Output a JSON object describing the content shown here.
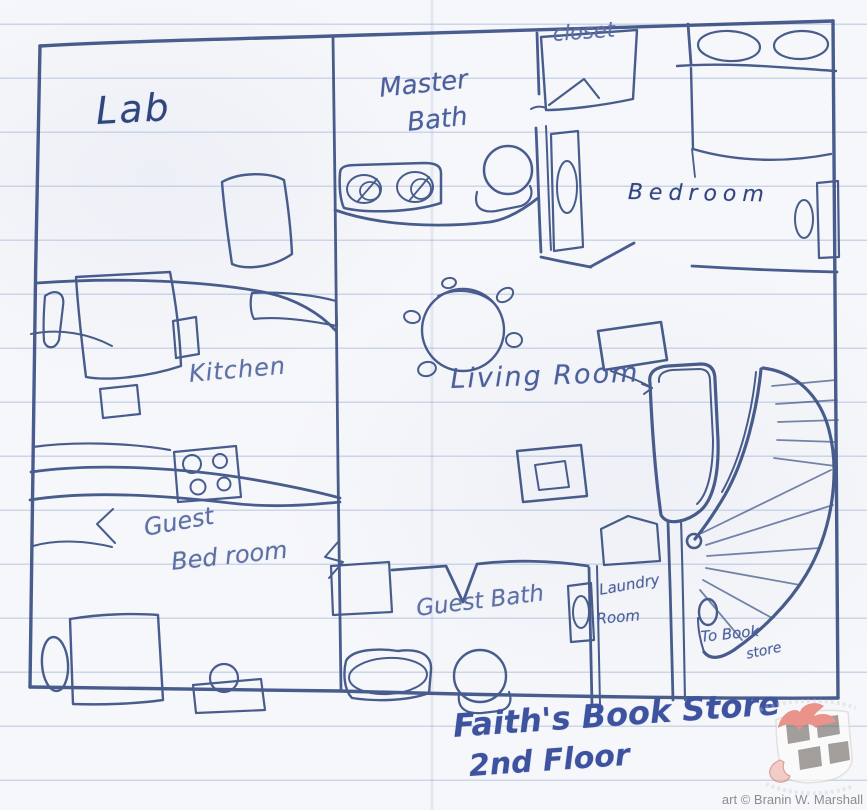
{
  "floor_plan": {
    "labels": {
      "lab": "Lab",
      "master_bath": {
        "line1": "Master",
        "line2": "Bath"
      },
      "closet": "closet",
      "bedroom": "Bedroom",
      "kitchen": "Kitchen",
      "living_room": "Living Room",
      "guest_bedroom": {
        "line1": "Guest",
        "line2": "Bed room"
      },
      "guest_bath": "Guest Bath",
      "laundry_room": {
        "line1": "Laundry",
        "line2": "Room"
      },
      "stairs_note": {
        "line1": "To Book",
        "line2": "store"
      }
    },
    "caption": {
      "line1": "Faith's Book Store",
      "line2": "2nd Floor"
    }
  },
  "footer": {
    "credit": "art © Branin W. Marshall"
  },
  "colors": {
    "ink": "#31487e",
    "rule_line": "#6c8abe",
    "credit_text": "#8d8d8d",
    "logo_red": "#e25747",
    "logo_checker": "#6e6862"
  }
}
